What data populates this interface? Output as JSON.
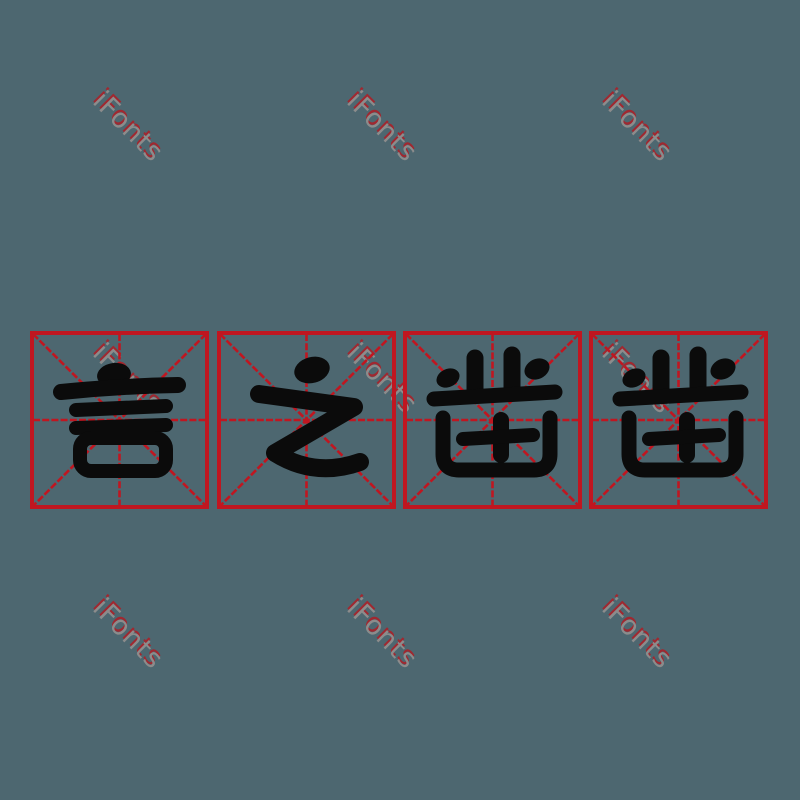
{
  "title": "言之凿凿",
  "characters": [
    {
      "char": "言"
    },
    {
      "char": "之"
    },
    {
      "char": "凿"
    },
    {
      "char": "凿"
    }
  ],
  "watermark": {
    "text": "iFonts",
    "count": 9
  },
  "colors": {
    "background": "#4d6770",
    "grid-red": "#c01620",
    "glyph-black": "#0b0b0b",
    "watermark-gray": "#8c8c8c",
    "watermark-shadow": "#a02830"
  }
}
